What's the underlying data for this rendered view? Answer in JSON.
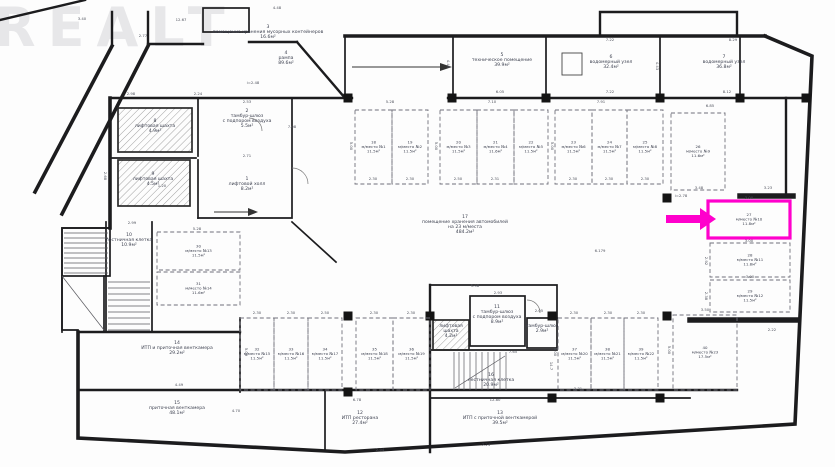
{
  "watermark": "REALT",
  "highlight": {
    "color": "#ff00cc",
    "target_room": "27",
    "target_stall": "м/место №10",
    "target_area": "11.8м²"
  },
  "rooms": [
    {
      "n": "1",
      "name": [
        "лифтовой холл"
      ],
      "area": "8.2м²",
      "x": 247,
      "y": 180
    },
    {
      "n": "2",
      "name": [
        "тамбур-шлюз",
        "с подпором воздуха"
      ],
      "area": "5.5м²",
      "x": 247,
      "y": 112
    },
    {
      "n": "3",
      "name": [
        "помещение хранения мусорных контейнеров"
      ],
      "area": "16.6м²",
      "x": 268,
      "y": 28
    },
    {
      "n": "4",
      "name": [
        "рампа"
      ],
      "area": "89.6м²",
      "x": 286,
      "y": 54
    },
    {
      "n": "5",
      "name": [
        "техническое помещение"
      ],
      "area": "39.9м²",
      "x": 502,
      "y": 56
    },
    {
      "n": "6",
      "name": [
        "водомерный узел"
      ],
      "area": "32.4м²",
      "x": 611,
      "y": 58
    },
    {
      "n": "7",
      "name": [
        "водомерный узел"
      ],
      "area": "36.8м²",
      "x": 724,
      "y": 58
    },
    {
      "n": "8",
      "name": [
        "лифтовая шахта"
      ],
      "area": "4.9м²",
      "x": 155,
      "y": 122
    },
    {
      "n": "9",
      "name": [
        "лифтовая шахта"
      ],
      "area": "4.5м²",
      "x": 153,
      "y": 175
    },
    {
      "n": "10",
      "name": [
        "лестничная клетка"
      ],
      "area": "10.9м²",
      "x": 129,
      "y": 236
    },
    {
      "n": "11",
      "name": [
        "тамбур-шлюз",
        "с подпором воздуха"
      ],
      "area": "8.9м²",
      "x": 497,
      "y": 308
    },
    {
      "n": "",
      "name": [
        "лифтовая",
        "шахта"
      ],
      "area": "4.2м²",
      "x": 451,
      "y": 327
    },
    {
      "n": "",
      "name": [
        "тамбур-шлюз"
      ],
      "area": "2.9м²",
      "x": 542,
      "y": 327
    },
    {
      "n": "16",
      "name": [
        "лестничная клетка"
      ],
      "area": "20.9м²",
      "x": 491,
      "y": 376
    },
    {
      "n": "12",
      "name": [
        "ИТП ресторана"
      ],
      "area": "27.4м²",
      "x": 360,
      "y": 414
    },
    {
      "n": "13",
      "name": [
        "ИТП с приточной венткамерой"
      ],
      "area": "39.5м²",
      "x": 500,
      "y": 414
    },
    {
      "n": "14",
      "name": [
        "ИТП и приточная венткамера"
      ],
      "area": "29.2м²",
      "x": 177,
      "y": 344
    },
    {
      "n": "15",
      "name": [
        "приточная венткамера"
      ],
      "area": "48.1м²",
      "x": 177,
      "y": 404
    },
    {
      "n": "17",
      "name": [
        "помещение хранения автомобилей",
        "на 23 м/места"
      ],
      "area": "484.2м²",
      "x": 465,
      "y": 218
    }
  ],
  "stalls": [
    {
      "room": "18",
      "stall": "м/место №1",
      "area": "11.5м²",
      "x": 355,
      "y": 110,
      "w": 37,
      "h": 74
    },
    {
      "room": "19",
      "stall": "м/место №2",
      "area": "11.5м²",
      "x": 392,
      "y": 110,
      "w": 36,
      "h": 74
    },
    {
      "room": "20",
      "stall": "м/место №3",
      "area": "11.5м²",
      "x": 440,
      "y": 110,
      "w": 37,
      "h": 74
    },
    {
      "room": "21",
      "stall": "м/место №4",
      "area": "11.6м²",
      "x": 477,
      "y": 110,
      "w": 37,
      "h": 74
    },
    {
      "room": "22",
      "stall": "м/место №5",
      "area": "11.5м²",
      "x": 514,
      "y": 110,
      "w": 34,
      "h": 74
    },
    {
      "room": "23",
      "stall": "м/место №6",
      "area": "11.5м²",
      "x": 555,
      "y": 110,
      "w": 37,
      "h": 74
    },
    {
      "room": "24",
      "stall": "м/место №7",
      "area": "11.5м²",
      "x": 592,
      "y": 110,
      "w": 35,
      "h": 74
    },
    {
      "room": "25",
      "stall": "м/место №8",
      "area": "11.5м²",
      "x": 627,
      "y": 110,
      "w": 36,
      "h": 74
    },
    {
      "room": "26",
      "stall": "м/место №9",
      "area": "11.6м²",
      "x": 671,
      "y": 113,
      "w": 54,
      "h": 77
    },
    {
      "room": "27",
      "stall": "м/место №10",
      "area": "11.8м²",
      "x": 708,
      "y": 201,
      "w": 82,
      "h": 37,
      "highlight": true
    },
    {
      "room": "28",
      "stall": "м/место №11",
      "area": "11.8м²",
      "x": 710,
      "y": 243,
      "w": 80,
      "h": 34
    },
    {
      "room": "29",
      "stall": "м/место №12",
      "area": "11.5м²",
      "x": 710,
      "y": 280,
      "w": 80,
      "h": 32
    },
    {
      "room": "30",
      "stall": "м/место №13",
      "area": "11.5м²",
      "x": 157,
      "y": 232,
      "w": 83,
      "h": 38
    },
    {
      "room": "31",
      "stall": "м/место №14",
      "area": "11.6м²",
      "x": 157,
      "y": 272,
      "w": 83,
      "h": 33
    },
    {
      "room": "32",
      "stall": "м/место №15",
      "area": "11.5м²",
      "x": 240,
      "y": 318,
      "w": 34,
      "h": 72
    },
    {
      "room": "33",
      "stall": "м/место №16",
      "area": "11.5м²",
      "x": 274,
      "y": 318,
      "w": 34,
      "h": 72
    },
    {
      "room": "34",
      "stall": "м/место №17",
      "area": "11.5м²",
      "x": 308,
      "y": 318,
      "w": 34,
      "h": 72
    },
    {
      "room": "35",
      "stall": "м/место №18",
      "area": "11.5м²",
      "x": 356,
      "y": 318,
      "w": 37,
      "h": 72
    },
    {
      "room": "36",
      "stall": "м/место №19",
      "area": "11.5м²",
      "x": 393,
      "y": 318,
      "w": 37,
      "h": 72
    },
    {
      "room": "37",
      "stall": "м/место №20",
      "area": "11.5м²",
      "x": 558,
      "y": 318,
      "w": 33,
      "h": 72
    },
    {
      "room": "38",
      "stall": "м/место №21",
      "area": "11.5м²",
      "x": 591,
      "y": 318,
      "w": 33,
      "h": 72
    },
    {
      "room": "39",
      "stall": "м/место №22",
      "area": "11.5м²",
      "x": 624,
      "y": 318,
      "w": 34,
      "h": 72
    },
    {
      "room": "40",
      "stall": "м/место №23",
      "area": "17.5м²",
      "x": 673,
      "y": 315,
      "w": 64,
      "h": 75
    }
  ],
  "dims": [
    [
      "3.40",
      82,
      20
    ],
    [
      "12.67",
      181,
      21
    ],
    [
      "4.48",
      277,
      9
    ],
    [
      "2.77",
      143,
      37
    ],
    [
      "2.98",
      131,
      95
    ],
    [
      "2.24",
      198,
      95
    ],
    [
      "2.53",
      247,
      103
    ],
    [
      "2.71",
      247,
      157
    ],
    [
      "1.20",
      162,
      187
    ],
    [
      "7.08",
      292,
      128
    ],
    [
      "i=2.48",
      253,
      84
    ],
    [
      "2.99",
      132,
      224
    ],
    [
      "5.28",
      197,
      230
    ],
    [
      "7.22",
      610,
      41
    ],
    [
      "8.29",
      733,
      41
    ],
    [
      "7.22",
      610,
      93
    ],
    [
      "8.12",
      727,
      93
    ],
    [
      "6.85",
      710,
      107
    ],
    [
      "4.43",
      656,
      66,
      90
    ],
    [
      "6.05",
      500,
      93
    ],
    [
      "4.46",
      447,
      64,
      90
    ],
    [
      "7.10",
      492,
      103
    ],
    [
      "5.28",
      390,
      103
    ],
    [
      "7.91",
      601,
      103
    ],
    [
      "2.30",
      373,
      180
    ],
    [
      "2.30",
      410,
      180
    ],
    [
      "2.50",
      458,
      180
    ],
    [
      "2.31",
      495,
      180
    ],
    [
      "2.30",
      573,
      180
    ],
    [
      "2.30",
      609,
      180
    ],
    [
      "2.30",
      645,
      180
    ],
    [
      "5.00",
      350,
      146,
      90
    ],
    [
      "5.00",
      435,
      146,
      90
    ],
    [
      "5.00",
      551,
      146,
      90
    ],
    [
      "3.48",
      699,
      189
    ],
    [
      "3.23",
      768,
      189
    ],
    [
      "i=2.78",
      681,
      197
    ],
    [
      "3.00",
      749,
      199
    ],
    [
      "3.00",
      749,
      242
    ],
    [
      "3.00",
      750,
      278
    ],
    [
      "2.92",
      705,
      261,
      90
    ],
    [
      "2.38",
      705,
      296,
      90
    ],
    [
      "2.22",
      772,
      331
    ],
    [
      "6.179",
      600,
      252
    ],
    [
      "2.30",
      257,
      314
    ],
    [
      "2.30",
      291,
      314
    ],
    [
      "2.50",
      325,
      314
    ],
    [
      "2.30",
      374,
      314
    ],
    [
      "2.30",
      411,
      314
    ],
    [
      "2.30",
      574,
      314
    ],
    [
      "2.30",
      608,
      314
    ],
    [
      "2.30",
      641,
      314
    ],
    [
      "3.50",
      705,
      311
    ],
    [
      "5.00",
      245,
      352,
      90
    ],
    [
      "5.00",
      554,
      352,
      90
    ],
    [
      "5.00",
      668,
      350,
      90
    ],
    [
      "5.98",
      475,
      287
    ],
    [
      "2.93",
      498,
      294
    ],
    [
      "2.05",
      539,
      312
    ],
    [
      "7.65",
      513,
      353
    ],
    [
      "14.7",
      550,
      366,
      90
    ],
    [
      "6.78",
      357,
      401
    ],
    [
      "12.80",
      495,
      401
    ],
    [
      "7.24",
      486,
      446
    ],
    [
      "2.94",
      380,
      451
    ],
    [
      "4.49",
      179,
      386
    ],
    [
      "3.31",
      578,
      390
    ],
    [
      "4.70",
      236,
      412
    ],
    [
      "2.68",
      104,
      176,
      90
    ]
  ]
}
